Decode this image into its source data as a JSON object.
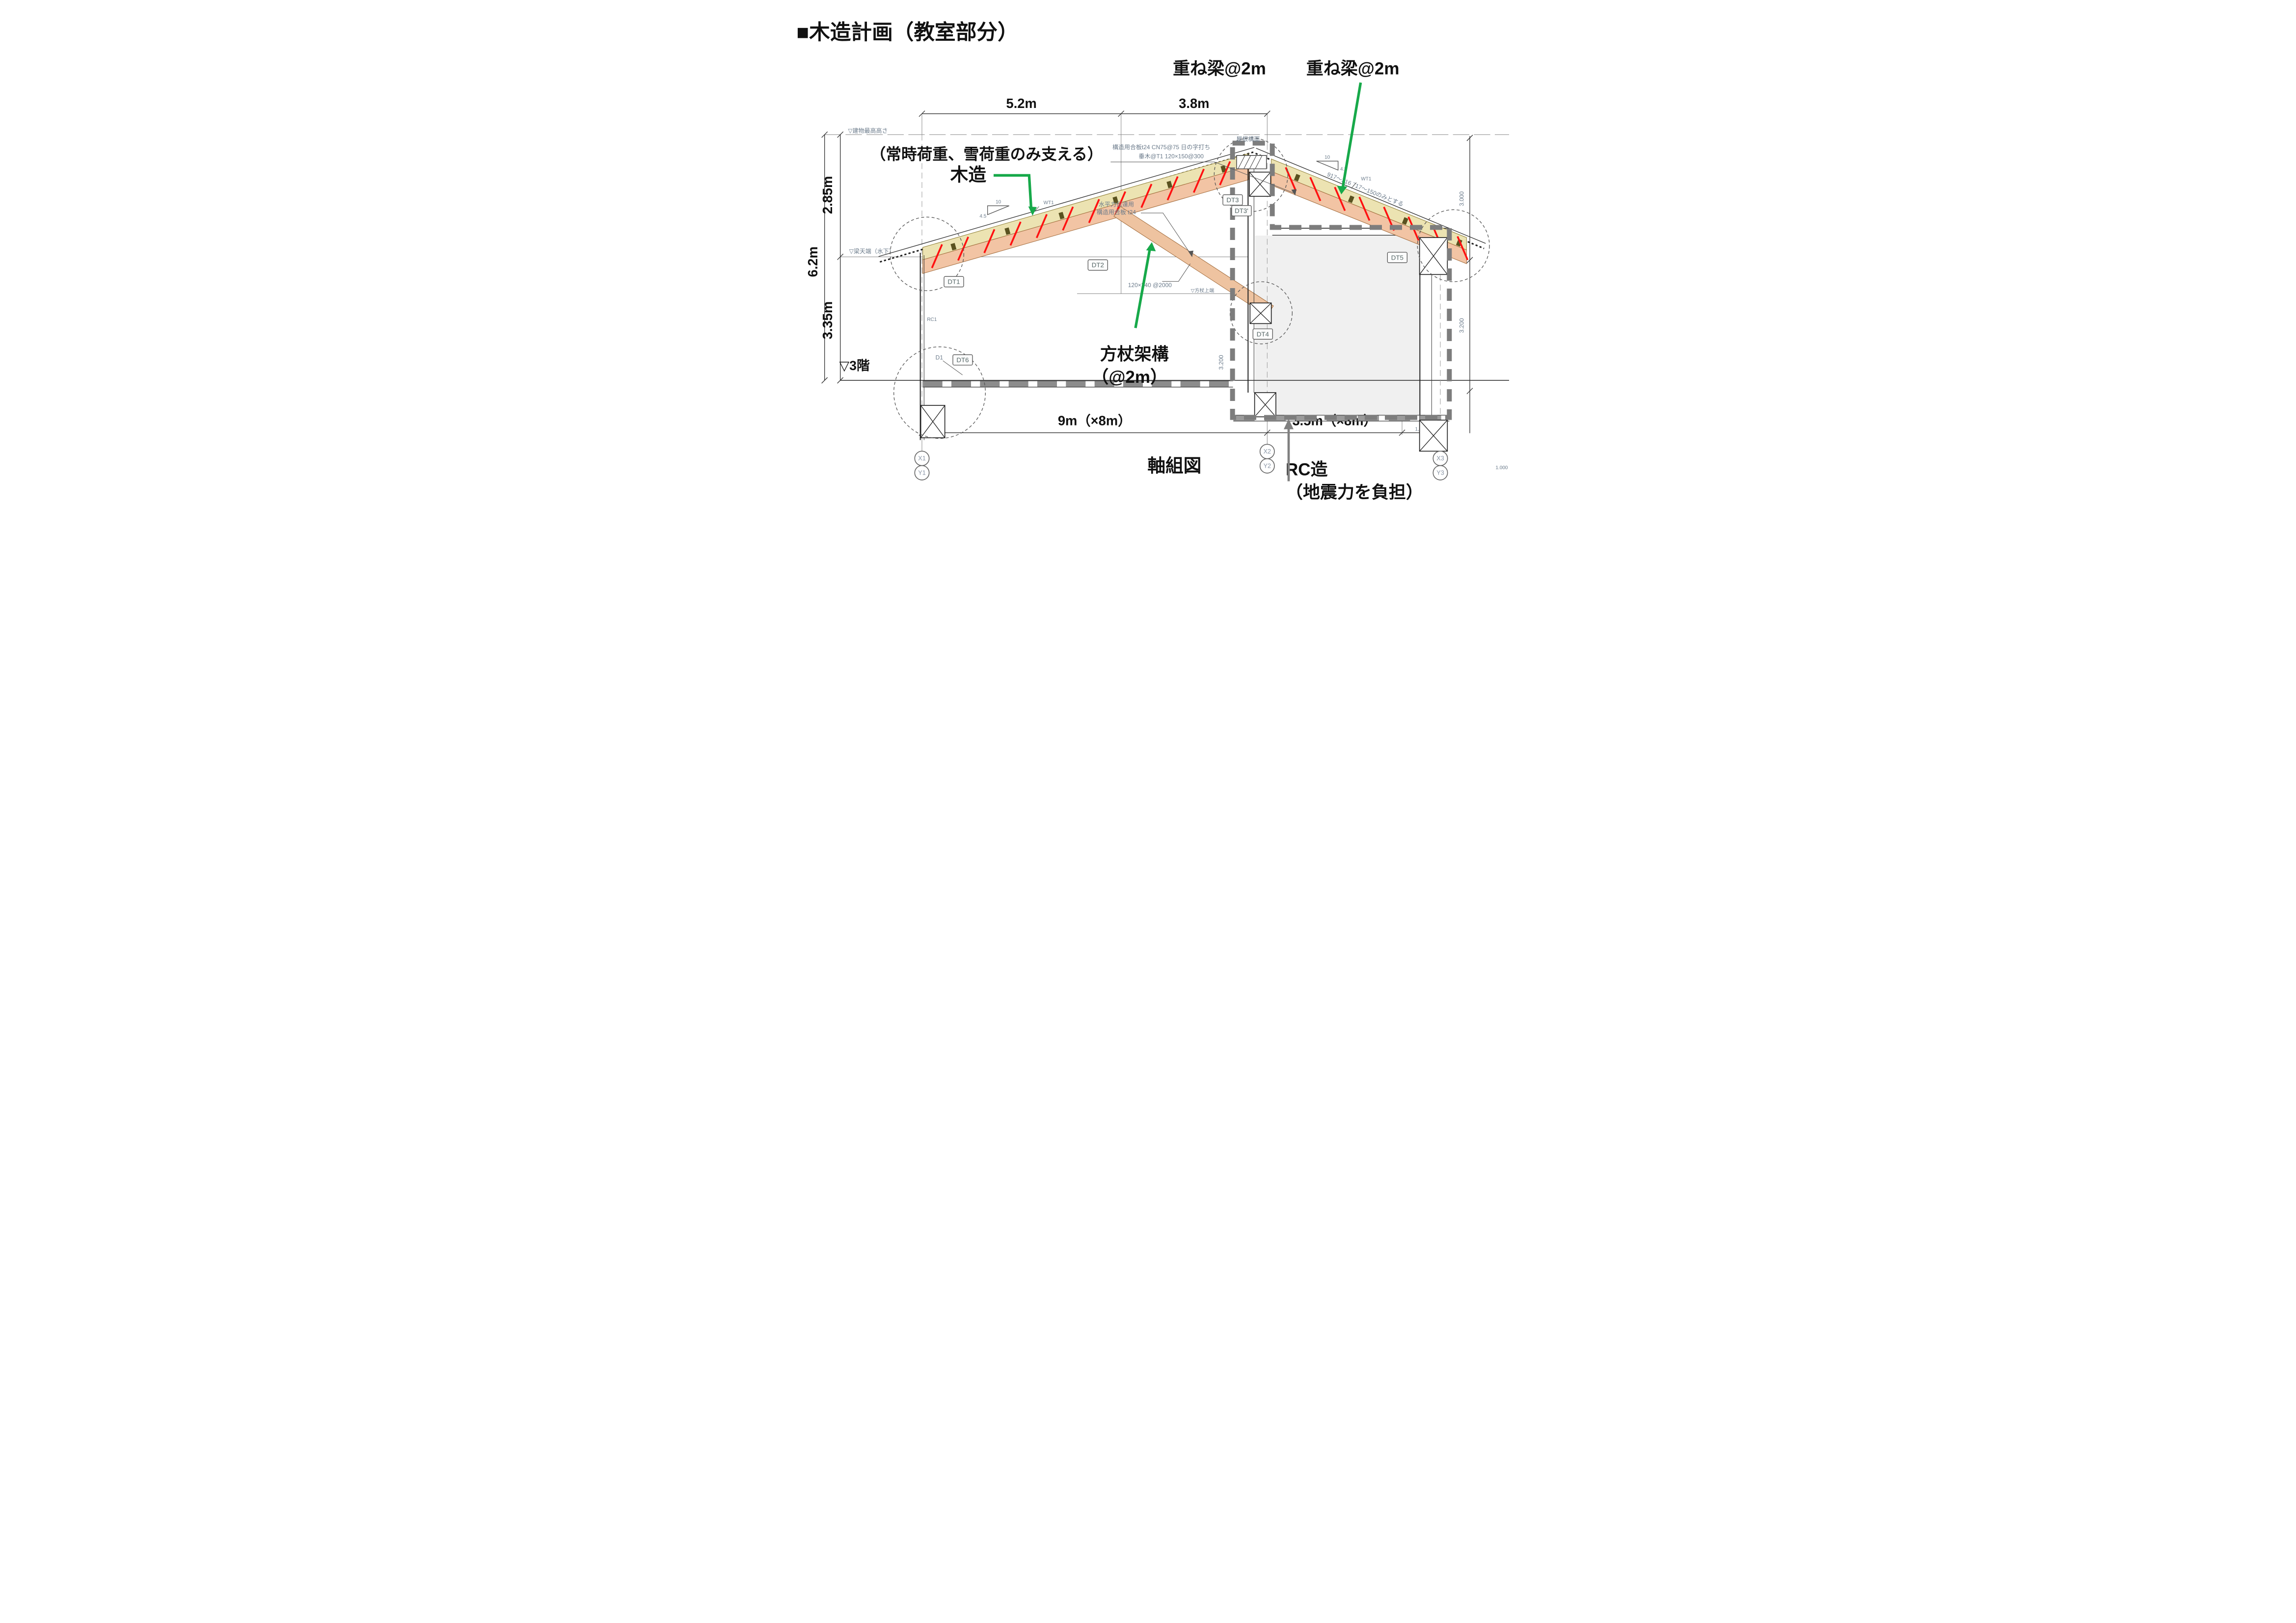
{
  "title": "■木造計画（教室部分）",
  "annotations": {
    "kasane1": "重ね梁@2m",
    "kasane2": "重ね梁@2m",
    "load_note": "（常時荷重、雪荷重のみ支える）",
    "mokuzo": "木造",
    "hojo_line1": "方杖架構",
    "hojo_line2": "（@2m）",
    "rc_line1": "RC造",
    "rc_line2": "（地震力を負担）",
    "jikugumi": "軸組図"
  },
  "dimensions": {
    "top1": "5.2m",
    "top2": "3.8m",
    "left_upper": "2.85m",
    "left_total": "6.2m",
    "left_lower": "3.35m",
    "bottom1": "9m（×8m）",
    "bottom2": "3.5m（×8m）",
    "small_1000": "1,000",
    "small_1000b": "1.000",
    "right_upper": "3.000",
    "right_lower": "3.200",
    "mid_wall": "3.200"
  },
  "levels": {
    "highest": "▽建物最高高さ",
    "beam_top": "▽梁天端（水下）",
    "brace_top": "▽方杖上端",
    "floor3": "▽3階"
  },
  "grid": {
    "x1": "X1",
    "y1": "Y1",
    "x2": "X2",
    "y2": "Y2",
    "x3": "X3",
    "y3": "Y3"
  },
  "details": {
    "dt1": "DT1",
    "dt2": "DT2",
    "dt3": "DT3",
    "dt3b": "DT3'",
    "dt4": "DT4",
    "dt5": "DT5",
    "dt6": "DT6",
    "d1": "D1",
    "rc1": "RC1",
    "wt1": "WT1"
  },
  "notes": {
    "roof_plane": "屋根構面",
    "sheathing": "構造用合板t24 CN75@75 日の字打ち",
    "rafter": "垂木@T1 120×150@300",
    "horiz_l1": "水平力伝達用",
    "horiz_l2": "構造用合板 t24",
    "brace_size": "120×240 @2000",
    "slope_run": "10",
    "slope_rise": "4.5",
    "right_roof_note": "917〜316 717〜150のみとする"
  },
  "colors": {
    "arrow_green": "#17a94a",
    "hatch_red": "#ff1111",
    "beam_yellow": "#ece3b2",
    "beam_orange": "#f2c4a4",
    "rc_boundary_gray": "#7d7d7d",
    "scan_blue": "#6a7a8a",
    "slab_gray": "#8c8c8c"
  }
}
